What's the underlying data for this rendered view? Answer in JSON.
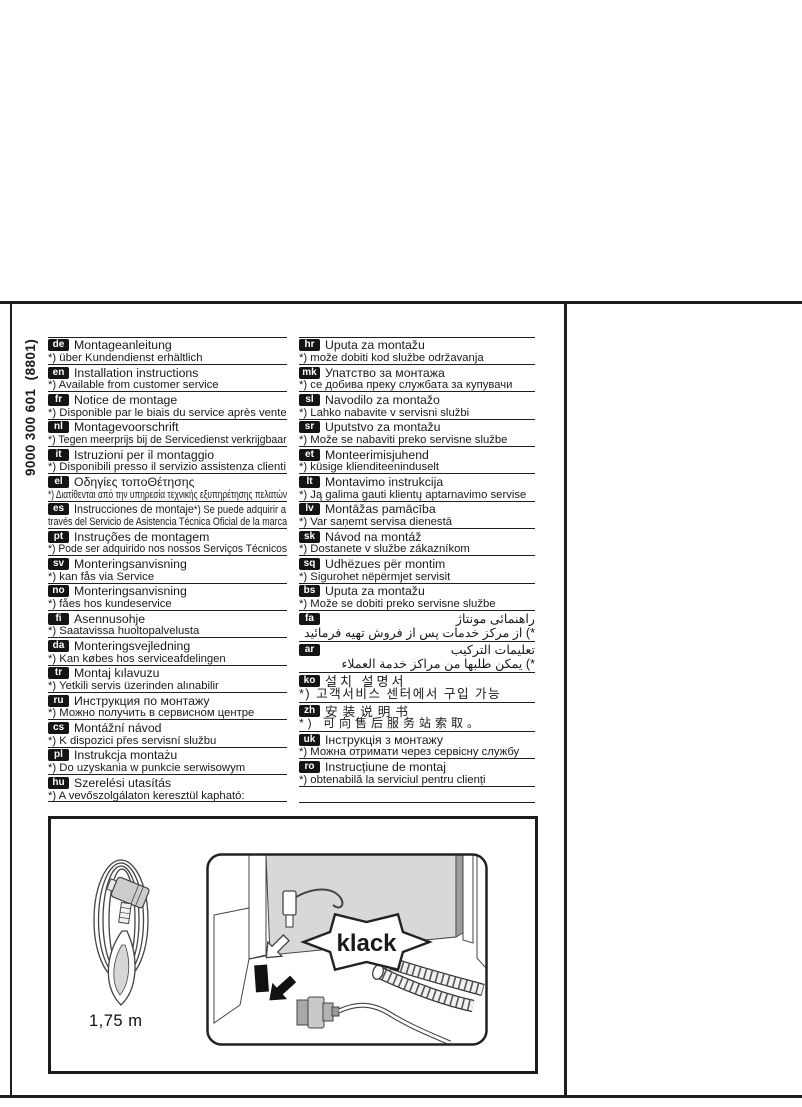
{
  "document": {
    "code_vertical": "9000 300 601  (8801)"
  },
  "languages": {
    "left": [
      {
        "code": "de",
        "title": "Montageanleitung",
        "note": "*) über Kundendienst erhältlich"
      },
      {
        "code": "en",
        "title": "Installation instructions",
        "note": "*) Available from customer service"
      },
      {
        "code": "fr",
        "title": "Notice de montage",
        "note": "*) Disponible par le biais du service après vente"
      },
      {
        "code": "nl",
        "title": "Montagevoorschrift",
        "note": "*) Tegen meerprijs bij de Servicedienst verkrijgbaar"
      },
      {
        "code": "it",
        "title": "Istruzioni per il montaggio",
        "note": "*) Disponibili presso il servizio assistenza clienti"
      },
      {
        "code": "el",
        "title": "Οδηγίες τοποΘέτησης",
        "note": "*) Διατίθενται από την υπηρεσία τεχνικής εξυπηρέτησης πελατών"
      },
      {
        "code": "es",
        "title": "Instrucciones de montaje",
        "title_suffix": "*) Se puede adquirir a",
        "note": "través del Servicio de Asistencia Técnica Oficial de la marca"
      },
      {
        "code": "pt",
        "title": "Instruções de montagem",
        "note": "*) Pode ser adquirido nos nossos Serviços Técnicos"
      },
      {
        "code": "sv",
        "title": "Monteringsanvisning",
        "note": "*) kan fås via Service"
      },
      {
        "code": "no",
        "title": "Monteringsanvisning",
        "note": "*) fåes hos kundeservice"
      },
      {
        "code": "fi",
        "title": "Asennusohje",
        "note": "*) Saatavissa huoltopalvelusta"
      },
      {
        "code": "da",
        "title": "Monteringsvejledning",
        "note": "*) Kan købes hos serviceafdelingen"
      },
      {
        "code": "tr",
        "title": "Montaj kılavuzu",
        "note": "*) Yetkili servis üzerinden alınabilir"
      },
      {
        "code": "ru",
        "title": "Инструкция по монтажу",
        "note": "*) Можно получить в сервисном центре"
      },
      {
        "code": "cs",
        "title": "Montážní návod",
        "note": "*) K dispozici přes servisní službu"
      },
      {
        "code": "pl",
        "title": "Instrukcja montażu",
        "note": "*) Do uzyskania w punkcie serwisowym"
      },
      {
        "code": "hu",
        "title": "Szerelési utasítás",
        "note": "*) A vevőszolgálaton keresztül kapható:"
      }
    ],
    "right": [
      {
        "code": "hr",
        "title": "Uputa za montažu",
        "note": "*) može dobiti kod službe održavanja"
      },
      {
        "code": "mk",
        "title": "Упатство за монтажа",
        "note": "*) се добива преку службата за купувачи"
      },
      {
        "code": "sl",
        "title": "Navodilo za montažo",
        "note": "*) Lahko nabavite v servisni službi"
      },
      {
        "code": "sr",
        "title": "Uputstvo za montažu",
        "note": "*) Može se nabaviti preko servisne službe"
      },
      {
        "code": "et",
        "title": "Monteerimisjuhend",
        "note": "*) küsige klienditeeninduselt"
      },
      {
        "code": "lt",
        "title": "Montavimo instrukcija",
        "note": "*) Ją galima gauti klientų aptarnavimo servise"
      },
      {
        "code": "lv",
        "title": "Montāžas pamācība",
        "note": "*) Var saņemt servisa dienestā"
      },
      {
        "code": "sk",
        "title": "Návod na montáž",
        "note": "*) Dostanete v službe zákazníkom"
      },
      {
        "code": "sq",
        "title": "Udhëzues për montim",
        "note": "*) Sigurohet nëpërmjet servisit"
      },
      {
        "code": "bs",
        "title": "Uputa za montažu",
        "note": "*) Može se dobiti preko servisne službe"
      },
      {
        "code": "fa",
        "script": "rtl",
        "title": "راهنمائی مونتاژ",
        "note": "*) از مرکز خدمات پس از فروش تهیه فرمائید"
      },
      {
        "code": "ar",
        "script": "rtl",
        "title": "تعليمات التركيب",
        "note": "*) يمكن طلبها من مراكز خدمة العملاء"
      },
      {
        "code": "ko",
        "script": "ko",
        "title": "설치 설명서",
        "note": "*) 고객서비스 센터에서 구입 가능"
      },
      {
        "code": "zh",
        "script": "zh",
        "title": "安装说明书",
        "note": "*) 可向售后服务站索取。"
      },
      {
        "code": "uk",
        "title": "Інструкція з монтажу",
        "note": "*) Можна отримати через сервісну службу"
      },
      {
        "code": "ro",
        "title": "Instrucțiune de montaj",
        "note": "*) obtenabilă la serviciul pentru clienți"
      }
    ]
  },
  "illustration": {
    "cable_length_label": "1,75 m",
    "sound_label": "klack"
  },
  "colors": {
    "ink": "#1f1f1f",
    "badge_bg": "#141414",
    "panel_gray": "#d8d8d8"
  }
}
